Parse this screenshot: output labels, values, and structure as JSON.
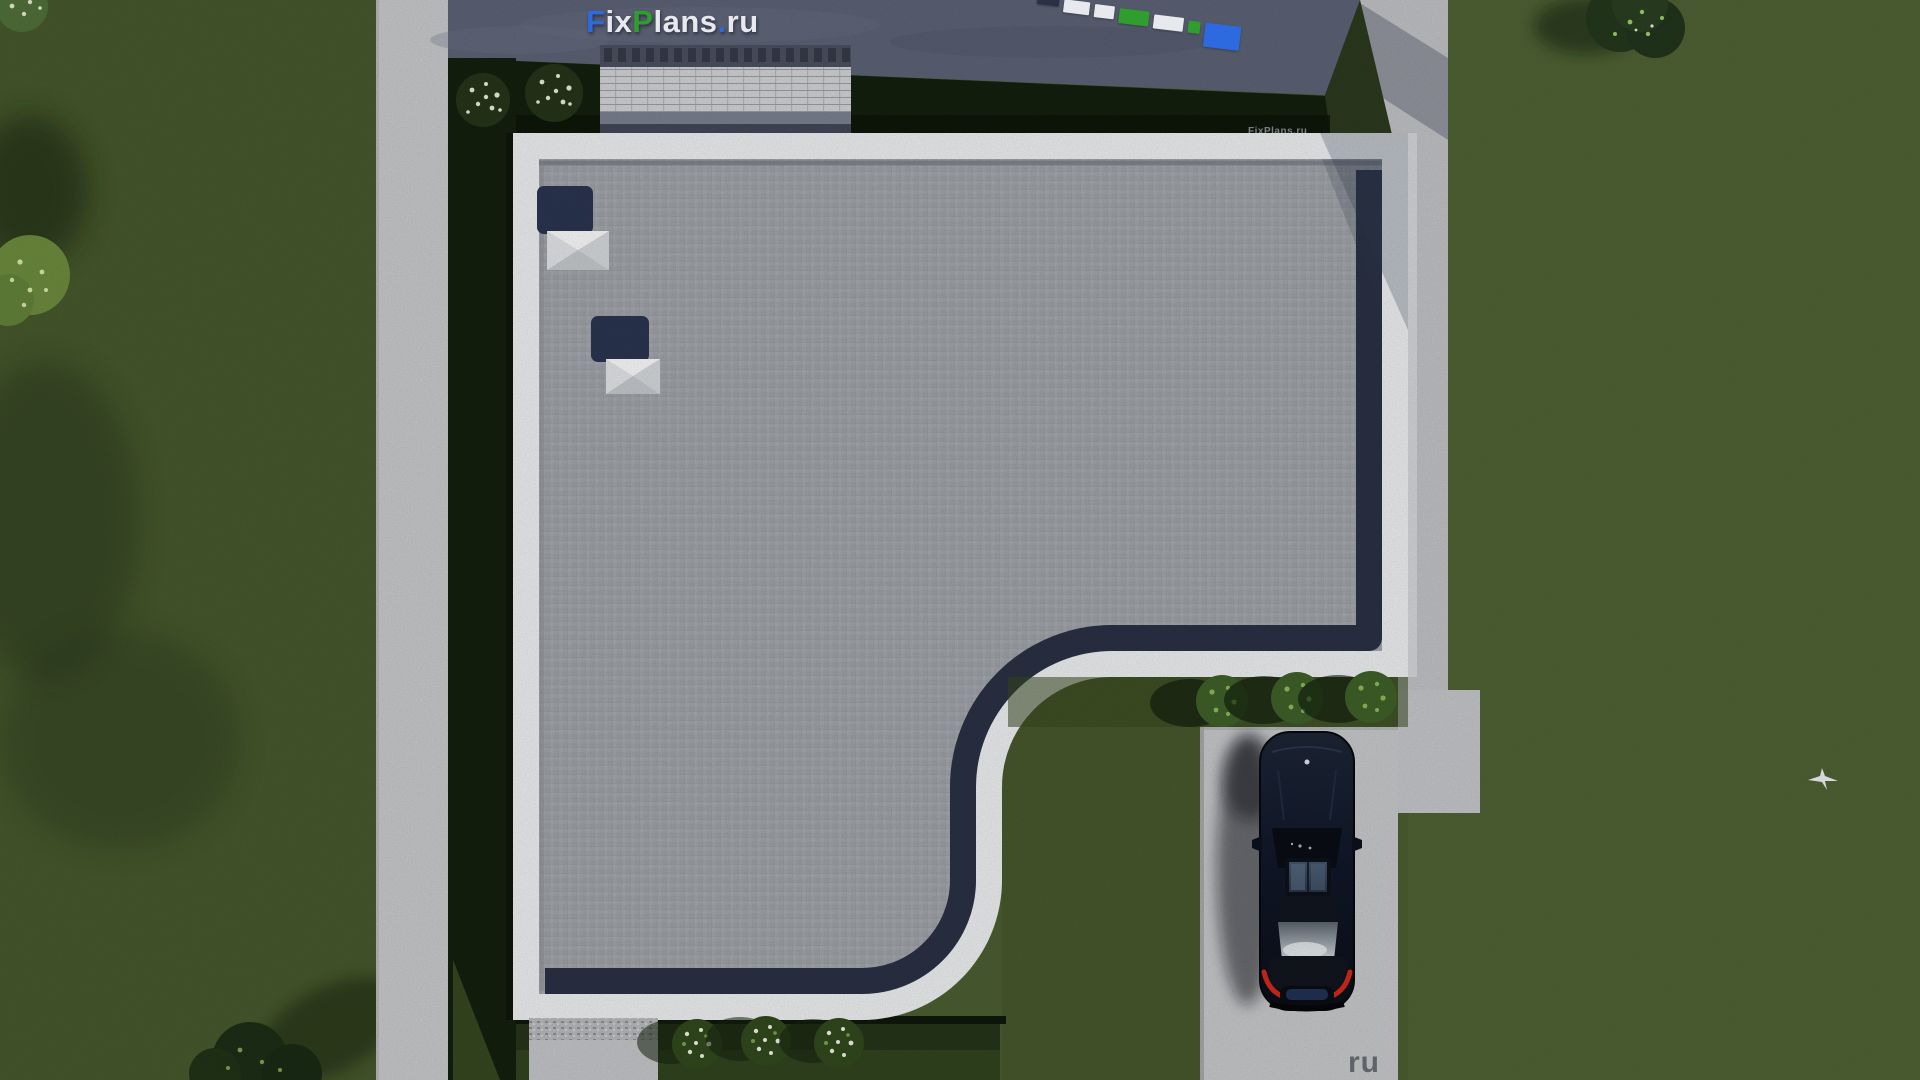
{
  "watermarks": {
    "logo": {
      "full_text": "FixPlans.ru",
      "segments": [
        {
          "text": "F",
          "color_key": "logo_blue"
        },
        {
          "text": "ix",
          "color_key": "logo_white"
        },
        {
          "text": "P",
          "color_key": "logo_green"
        },
        {
          "text": "lans",
          "color_key": "logo_white"
        },
        {
          "text": ".",
          "color_key": "logo_blue"
        },
        {
          "text": "ru",
          "color_key": "logo_white"
        }
      ]
    },
    "partial_bar": {
      "note": "letter bottoms of a second watermark cut off by the top edge",
      "blocks": [
        {
          "color_key": "navy",
          "w": 22,
          "h": 10,
          "dy": 0
        },
        {
          "color_key": "logo_white",
          "w": 26,
          "h": 13,
          "dy": 2
        },
        {
          "color_key": "logo_white",
          "w": 20,
          "h": 13,
          "dy": 3
        },
        {
          "color_key": "logo_green",
          "w": 30,
          "h": 15,
          "dy": 4
        },
        {
          "color_key": "logo_white",
          "w": 30,
          "h": 14,
          "dy": 6
        },
        {
          "color_key": "logo_green",
          "w": 12,
          "h": 12,
          "dy": 8
        },
        {
          "color_key": "logo_blue",
          "w": 36,
          "h": 24,
          "dy": 8
        }
      ]
    },
    "faint": {
      "text": "FixPlans.ru"
    },
    "corner": {
      "text": "ru"
    }
  },
  "colors": {
    "grass_base": "#4c5e31",
    "grass_light": "#5a6e3d",
    "shadow_strip": "#15200e",
    "road": "#5d6376",
    "concrete": "#c9cacc",
    "parapet": "#eef0f1",
    "roof": "#a3a6ab",
    "navy": "#2a3144",
    "car_body": "#131927",
    "taillight": "#d3291b",
    "bush_green": "#3f6128",
    "flower_white": "#eef2e0",
    "logo_blue": "#2d6ae0",
    "logo_green": "#2f9e2f",
    "logo_white": "#e8e9ee"
  },
  "scene": {
    "view": "aerial top-down render of flat-roof house plot",
    "objects": {
      "skylights": 2,
      "driveway_bushes": 3,
      "flower_bushes_bottom": 3,
      "flower_bushes_top": 2,
      "cars": 1,
      "birds": 1
    }
  }
}
